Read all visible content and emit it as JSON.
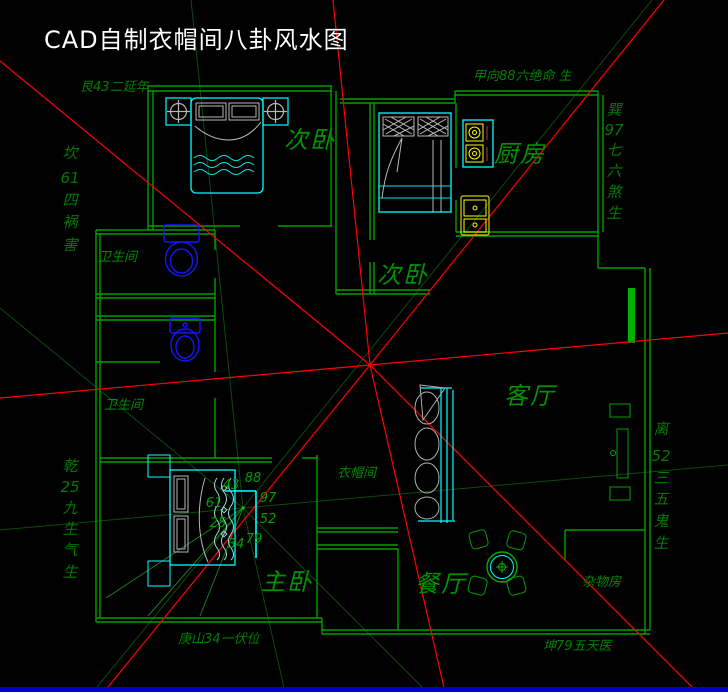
{
  "title": "CAD自制衣帽间八卦风水图",
  "compass": {
    "top_left": "艮43二延年",
    "top_right": "甲向88六绝命 生",
    "bottom_center": "庚山34一伏位",
    "bottom_right": "坤79五天医",
    "left_upper": {
      "name": "坎61四祸害",
      "chars": [
        "坎",
        "61",
        "四",
        "祸",
        "害"
      ]
    },
    "left_lower": {
      "name": "乾25九生气生",
      "chars": [
        "乾",
        "25",
        "九",
        "生",
        "气",
        "生"
      ]
    },
    "right_upper": {
      "name": "巽97七六煞生",
      "chars": [
        "巽",
        "97",
        "七",
        "六",
        "煞",
        "生"
      ]
    },
    "right_lower": {
      "name": "离52三五鬼生",
      "chars": [
        "离",
        "52",
        "三",
        "五",
        "鬼",
        "生"
      ]
    }
  },
  "rooms": {
    "bedroom_top": "次卧",
    "kitchen": "厨房",
    "bedroom_mid": "次卧",
    "living": "客厅",
    "bath_upper": "卫生间",
    "bath_lower": "卫生间",
    "cloakroom": "衣帽间",
    "master": "主卧",
    "dining": "餐厅",
    "storage": "杂物房"
  },
  "bagua_numbers": {
    "n43": "43",
    "n88": "88",
    "n61": "61",
    "n97": "97",
    "n25": "25",
    "n52": "52",
    "n34": "34",
    "n79": "79"
  },
  "colors": {
    "background": "#000000",
    "walls": "#00a000",
    "bagua_lines": "#ff0000",
    "mini_bagua_lines": "#0c4a0c",
    "furniture": "#00ffff",
    "toilet": "#1414ff",
    "appliance": "#ffff00",
    "labels": "#008800",
    "title": "#ffffff",
    "bottom_bar": "#0000cc"
  }
}
